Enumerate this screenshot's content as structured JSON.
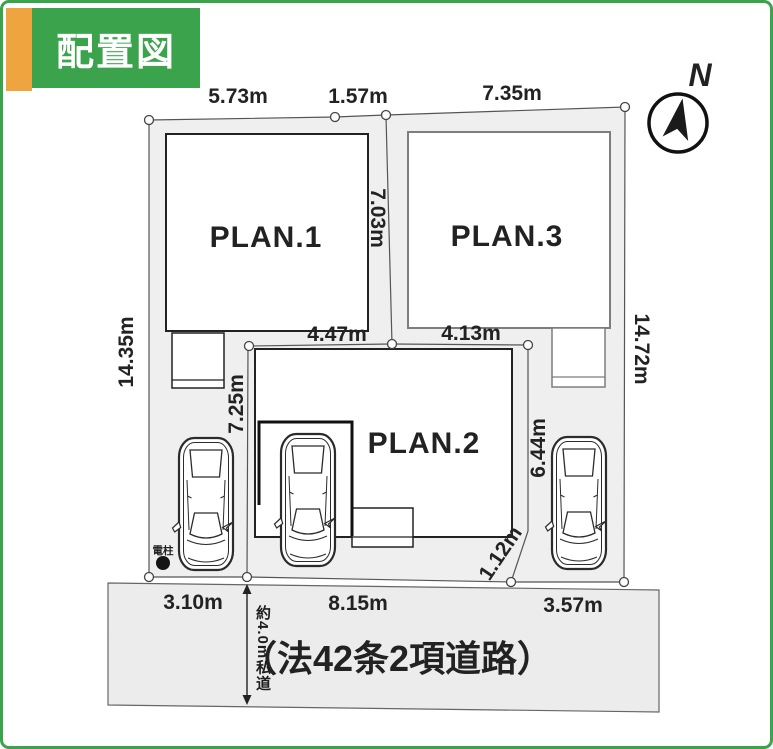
{
  "title": {
    "label": "配置図"
  },
  "compass": {
    "label": "N"
  },
  "plans": {
    "plan1": "PLAN.1",
    "plan2": "PLAN.2",
    "plan3": "PLAN.3"
  },
  "dimensions": {
    "top_left": "5.73m",
    "top_mid": "1.57m",
    "top_right": "7.35m",
    "left_side": "14.35m",
    "right_side": "14.72m",
    "mid_vertical": "7.03m",
    "mid_left_vertical": "7.25m",
    "mid_horiz_left": "4.47m",
    "mid_horiz_right": "4.13m",
    "mid_right_vertical": "6.44m",
    "diagonal": "1.12m",
    "bottom_left": "3.10m",
    "bottom_mid": "8.15m",
    "bottom_right": "3.57m"
  },
  "road": {
    "label": "（法42条2項道路）",
    "width_note": "約4.0m私道"
  },
  "pole": {
    "label": "電柱"
  },
  "colors": {
    "accent_green": "#3aa34b",
    "accent_orange": "#eea43f",
    "lot_fill": "#efefef",
    "road_fill": "#ececec",
    "line": "#555555",
    "building_outline": "#222222",
    "plan3_outline": "#7d7d7d"
  }
}
